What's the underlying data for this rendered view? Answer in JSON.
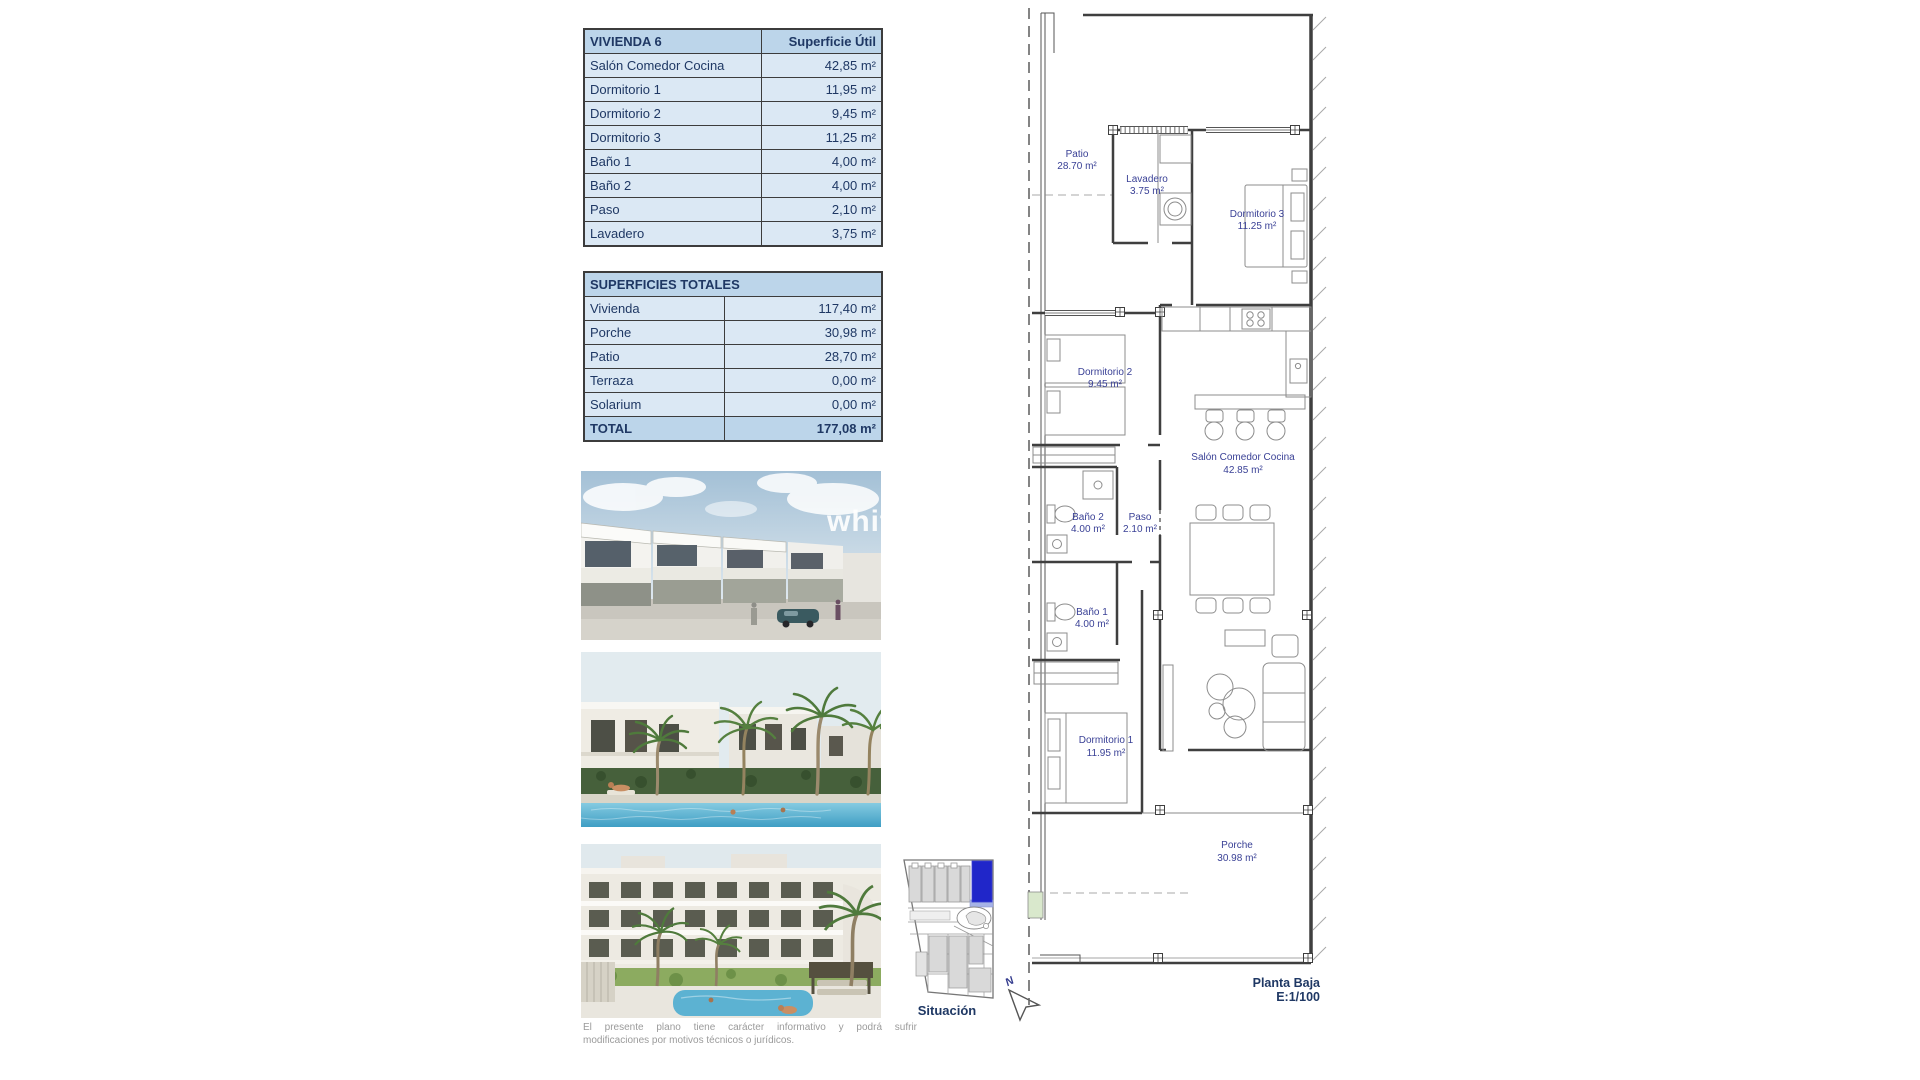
{
  "vivienda_table": {
    "title": "VIVIENDA 6",
    "header_right": "Superficie Útil",
    "rows": [
      {
        "label": "Salón Comedor Cocina",
        "value": "42,85 m²"
      },
      {
        "label": "Dormitorio 1",
        "value": "11,95 m²"
      },
      {
        "label": "Dormitorio 2",
        "value": "9,45 m²"
      },
      {
        "label": "Dormitorio 3",
        "value": "11,25 m²"
      },
      {
        "label": "Baño 1",
        "value": "4,00 m²"
      },
      {
        "label": "Baño 2",
        "value": "4,00 m²"
      },
      {
        "label": "Paso",
        "value": "2,10 m²"
      },
      {
        "label": "Lavadero",
        "value": "3,75 m²"
      }
    ]
  },
  "totales_table": {
    "title": "SUPERFICIES TOTALES",
    "rows": [
      {
        "label": "Vivienda",
        "value": "117,40 m²"
      },
      {
        "label": "Porche",
        "value": "30,98 m²"
      },
      {
        "label": "Patio",
        "value": "28,70 m²"
      },
      {
        "label": "Terraza",
        "value": "0,00 m²"
      },
      {
        "label": "Solarium",
        "value": "0,00 m²"
      }
    ],
    "total": {
      "label": "TOTAL",
      "value": "177,08 m²"
    }
  },
  "photos": {
    "watermark": "white"
  },
  "sitemap": {
    "label": "Situación"
  },
  "compass": {
    "north": "N"
  },
  "plan": {
    "title": "Planta Baja",
    "scale": "E:1/100",
    "rooms": [
      {
        "name": "Patio",
        "area": "28.70 m²"
      },
      {
        "name": "Lavadero",
        "area": "3.75 m²"
      },
      {
        "name": "Dormitorio 3",
        "area": "11.25 m²"
      },
      {
        "name": "Dormitorio 2",
        "area": "9.45 m²"
      },
      {
        "name": "Salón Comedor Cocina",
        "area": "42.85 m²"
      },
      {
        "name": "Baño 2",
        "area": "4.00 m²"
      },
      {
        "name": "Paso",
        "area": "2.10 m²"
      },
      {
        "name": "Baño 1",
        "area": "4.00 m²"
      },
      {
        "name": "Dormitorio 1",
        "area": "11.95 m²"
      },
      {
        "name": "Porche",
        "area": "30.98 m²"
      }
    ]
  },
  "disclaimer": {
    "line1": "El presente plano tiene carácter informativo y podrá sufrir",
    "line2": "modificaciones por motivos técnicos o jurídicos."
  },
  "colors": {
    "table_header_fill": "#bcd5ea",
    "table_row_fill": "#dbe8f4",
    "navy_text": "#1f3864",
    "plan_label_blue": "#3a4196",
    "highlight_unit_blue": "#2026c9",
    "plan_green": "#d9e8cc"
  }
}
